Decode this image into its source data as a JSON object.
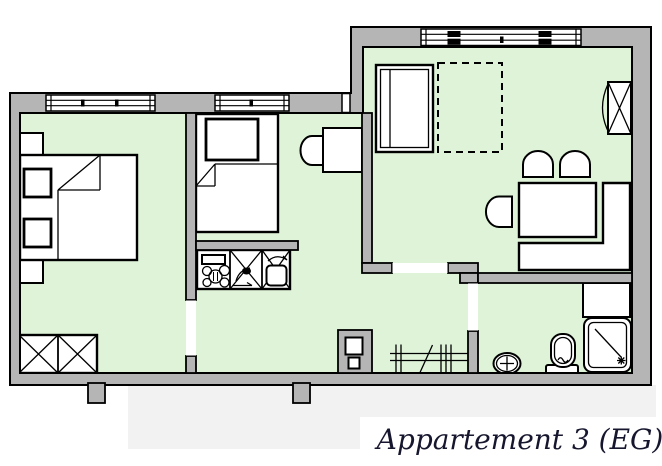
{
  "title": {
    "label": "Appartement 3 (EG)"
  },
  "colors": {
    "background": "#ffffff",
    "wall_fill": "#b5b5b5",
    "wall_outline": "#000000",
    "floor_fill": "#def3d8",
    "furniture_fill": "#ffffff",
    "furniture_outline": "#000000",
    "shadow": "#f2f2f2",
    "title_text": "#16162e"
  },
  "plan": {
    "window_count": 3,
    "door_opening_count": 3,
    "symbols": [
      "double-bed",
      "pillow",
      "nightstand",
      "wardrobe-two-door",
      "single-bed",
      "desk-table",
      "chair",
      "kitchenette",
      "stove-burners",
      "kitchen-sink-basin",
      "counter-cupboard",
      "bed",
      "guest-bed-dashed",
      "dining-table",
      "corner-bench",
      "wardrobe-right",
      "hall-pillar",
      "coat-rack",
      "washbasin",
      "toilet",
      "shower"
    ]
  }
}
